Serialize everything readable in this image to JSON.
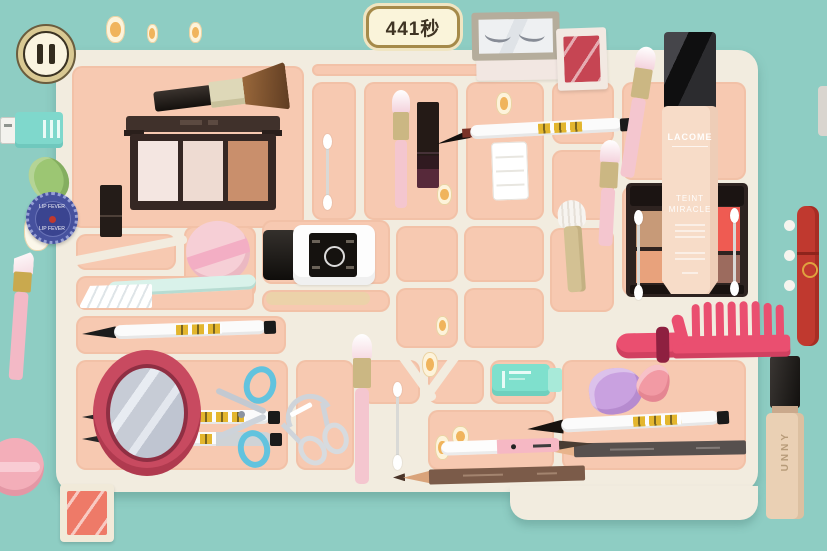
{
  "hud": {
    "timer": "441秒",
    "pause_icon": "pause"
  },
  "items": {
    "foundation": {
      "brand": "LACOME",
      "line1": "TEINT",
      "line2": "MIRACLE"
    },
    "concealer": {
      "brand": "UNNY"
    },
    "lip_tin": {
      "label": "LIP FEVER"
    }
  },
  "colors": {
    "background": "#8ecdc3",
    "tray_base": "#f2ecdf",
    "cell_pink": "#f7c9b1",
    "comb_red": "#e84a6b",
    "mirror_frame": "#c84a60",
    "timer_bg": "#faf4da",
    "timer_border": "#a58a4a",
    "scissors_blue": "#62c3de",
    "foundation_beige": "#f7dcc8"
  }
}
